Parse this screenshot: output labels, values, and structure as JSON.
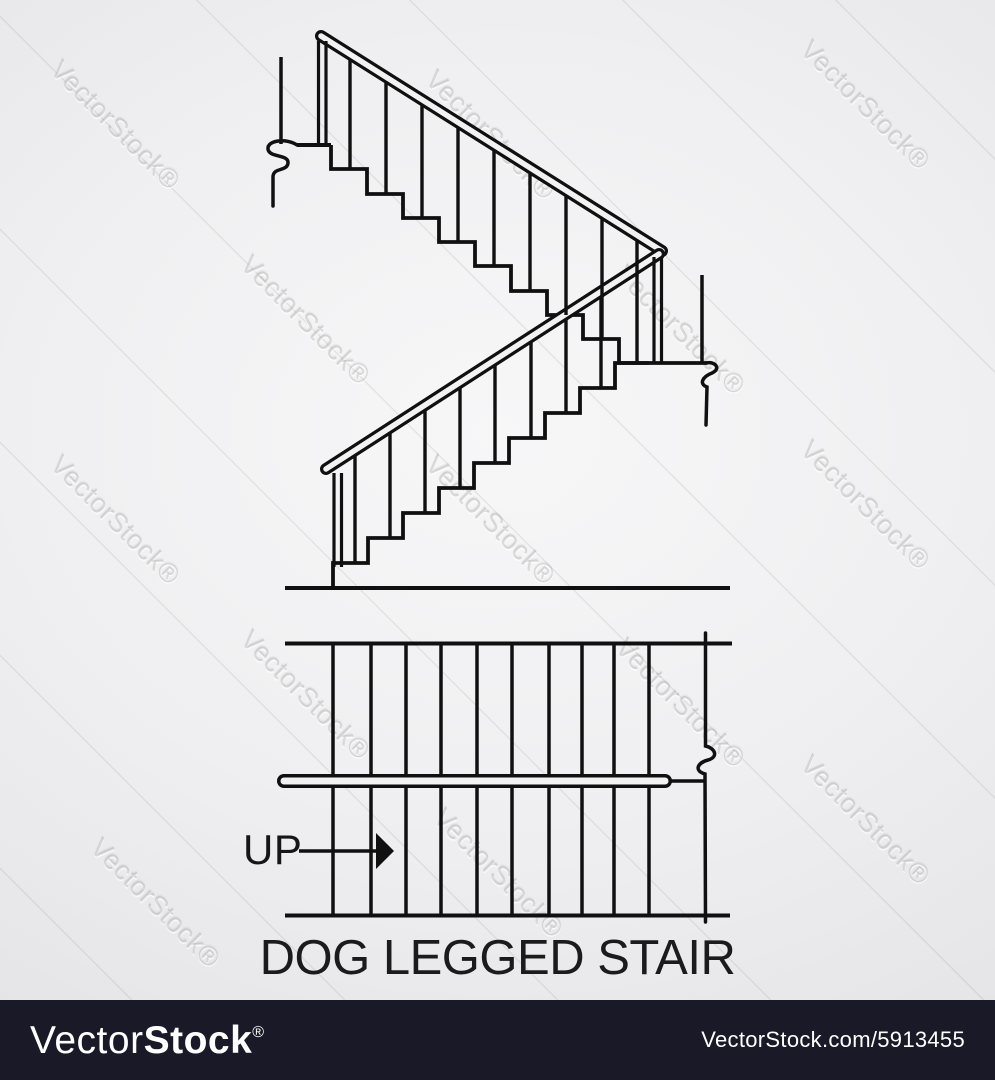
{
  "title": "DOG LEGGED STAIR",
  "plan": {
    "up_label": "UP"
  },
  "watermark": {
    "text": "VectorStock®"
  },
  "footer": {
    "logo_vector": "Vector",
    "logo_stock": "Stock",
    "logo_reg": "®",
    "url": "VectorStock.com/5913455"
  },
  "colors": {
    "ink": "#101010",
    "background_center": "#f7f7f8",
    "background_edge": "#d9d9db",
    "footer_bg": "#191927",
    "footer_text": "#ffffff"
  }
}
